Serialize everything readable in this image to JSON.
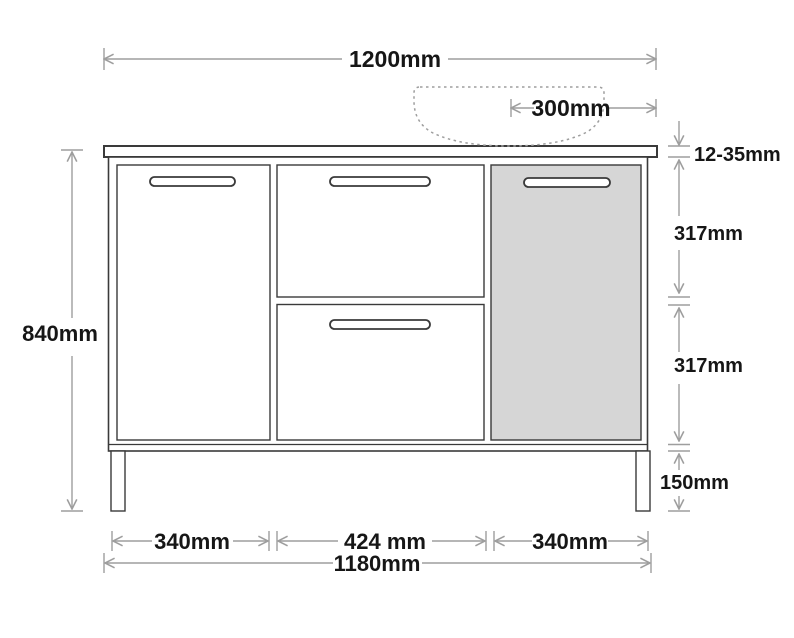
{
  "colors": {
    "ink": "#161616",
    "dim": "#9e9e9e",
    "outline": "#3a3a3a",
    "panel_fill": "#d6d6d6",
    "background": "#ffffff"
  },
  "dimensions": {
    "overall_top_width": "1200mm",
    "basin_offset": "300mm",
    "countertop_thickness": "12-35mm",
    "upper_section_height": "317mm",
    "lower_section_height": "317mm",
    "leg_height": "150mm",
    "overall_height": "840mm",
    "left_door_width": "340mm",
    "middle_section_width": "424 mm",
    "right_door_width": "340mm",
    "cabinet_width": "1180mm"
  }
}
